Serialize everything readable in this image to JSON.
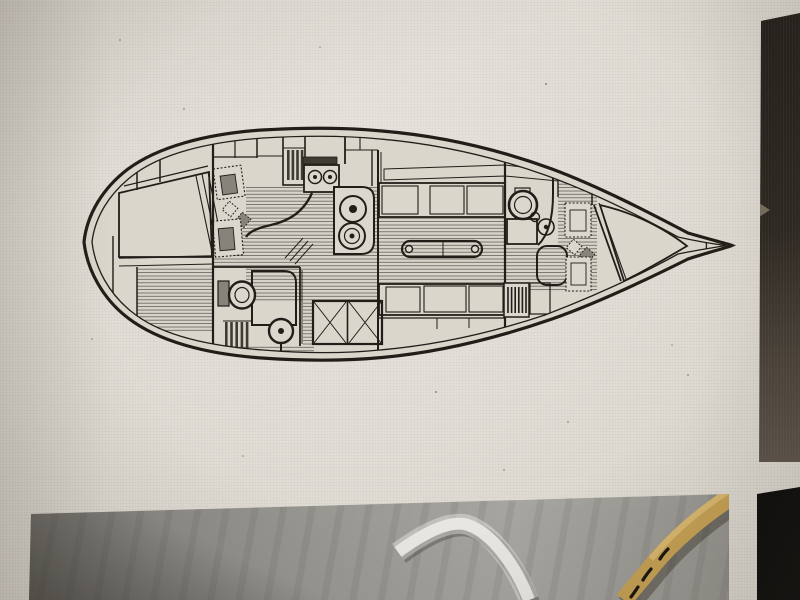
{
  "scene": {
    "kind": "photograph of a computer screen",
    "subject": "sailboat interior layout plan (top view, bow pointing right) on a white page, a partial photo of bilge hoses below it, and dark gallery thumbnails along the right edge",
    "visible_text": "none (no legible text in image)"
  },
  "colors": {
    "page_bg": "#dedad2",
    "ink": "#211d18",
    "hull_fill": "#d9d6cc",
    "fixture_fill": "#dad7ce",
    "dark_fill": "#3f3b32",
    "seat_dark": "#86837b",
    "floor_base": "#d6d3ca",
    "floor_line": "#57524a",
    "berth_bg": "#ddd9d0",
    "berth_dot": "#37332c",
    "grate_bg": "#c2bfb5",
    "cushion_gray": "#989589",
    "cushion_line": "#5d5951",
    "panel_dark_top": "#201c18",
    "panel_dark_bottom": "#6e645a",
    "black_thumb": "#0b0a09",
    "hose_white": "#e9e7e2",
    "hose_yellow": "#c49f52",
    "hose_mark": "#17130e"
  },
  "floorplan": {
    "orientation": "bow-right, stern-left",
    "compartments": [
      {
        "name": "aft-double-berth",
        "pattern": "dot-grid quilting",
        "position": "stern port side"
      },
      {
        "name": "aft-cabin-seats",
        "pattern": "dotted-border cushions with two diamond stools"
      },
      {
        "name": "aft-head",
        "items": [
          "toilet",
          "shower-grate",
          "companion-ladder",
          "pedestal-seat"
        ]
      },
      {
        "name": "companionway",
        "items": [
          "sliding-hatch-steps"
        ]
      },
      {
        "name": "galley",
        "items": [
          "two-burner-stove",
          "double-sink",
          "curved-counter"
        ]
      },
      {
        "name": "engine-box",
        "pattern": "diagonal crosshatch, two panels"
      },
      {
        "name": "salon",
        "items": [
          "port-settee",
          "starboard-settee",
          "drop-leaf-table-with-herringbone-top"
        ]
      },
      {
        "name": "forward-head",
        "items": [
          "toilet",
          "sink",
          "shower-grate",
          "curved-door"
        ]
      },
      {
        "name": "forward-cabin",
        "items": [
          "dotted-border-cushions",
          "diamond-stools",
          "hanging-locker-louvers"
        ]
      },
      {
        "name": "v-berth",
        "pattern": "dot-grid quilting triangle"
      },
      {
        "name": "anchor-locker",
        "position": "bow tip"
      }
    ]
  },
  "gallery": {
    "right_panel": {
      "label": "adjacent dark thumbnail strip, gradient dark to brown-gray"
    },
    "bottom_photo": {
      "label": "bilge photo",
      "elements": [
        "white-hose",
        "yellow-hose",
        "black-marking-on-yellow-hose"
      ]
    },
    "bottom_right_thumbnail": {
      "label": "black thumbnail corner"
    }
  }
}
